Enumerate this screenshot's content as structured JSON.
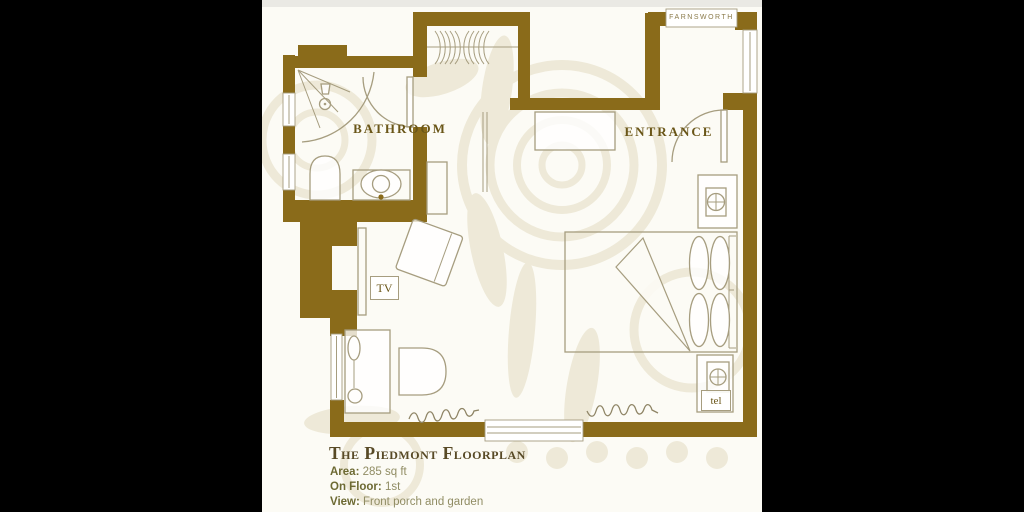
{
  "floorplan": {
    "rooms": {
      "bathroom_label": "BATHROOM",
      "entrance_label": "ENTRANCE"
    },
    "annotations": {
      "tv_label": "TV",
      "telephone_label": "tel",
      "window_brand_label": "FARNSWORTH"
    }
  },
  "title_block": {
    "title": "The Piedmont Floorplan",
    "details": [
      {
        "label": "Area:",
        "value": "285 sq ft"
      },
      {
        "label": "On Floor:",
        "value": "1st"
      },
      {
        "label": "View:",
        "value": "Front porch and garden"
      }
    ]
  },
  "colors": {
    "wall": "#8a6b1a",
    "line": "#a69d7f",
    "label": "#6a5618",
    "title": "#584a26",
    "detail_label": "#6d6a33",
    "detail_value": "#908c63",
    "bg": "#fcfbf5",
    "watermark": "#ece7d4"
  }
}
